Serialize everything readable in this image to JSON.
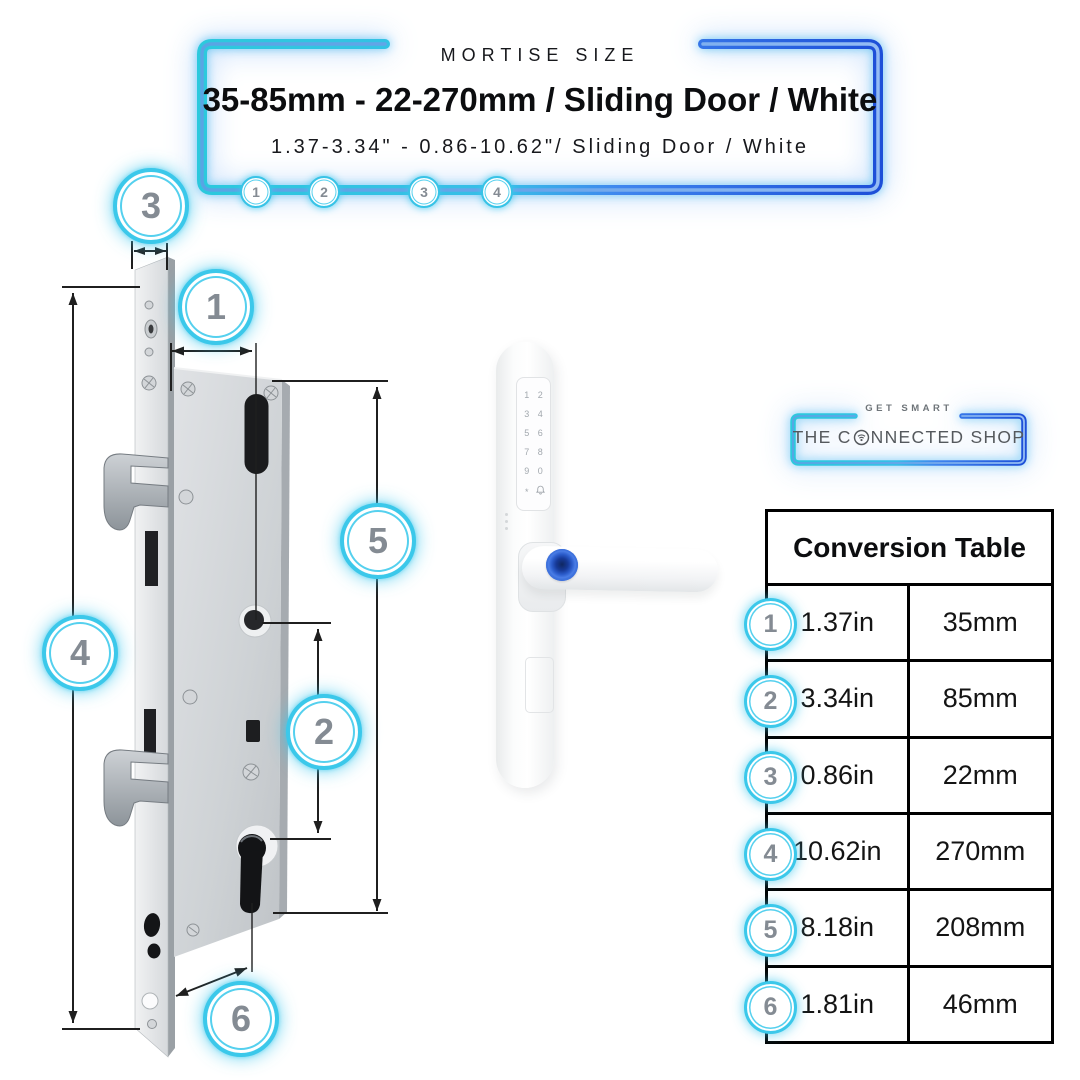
{
  "header": {
    "eyebrow": "MORTISE SIZE",
    "title": "35-85mm - 22-270mm / Sliding Door / White",
    "subtitle": "1.37-3.34\" - 0.86-10.62\"/ Sliding Door / White",
    "markers": [
      "1",
      "2",
      "3",
      "4"
    ]
  },
  "diagram": {
    "callouts": [
      "3",
      "1",
      "5",
      "4",
      "2",
      "6"
    ]
  },
  "handle": {
    "keys": [
      "1",
      "2",
      "3",
      "4",
      "5",
      "6",
      "7",
      "8",
      "9",
      "0",
      "*"
    ],
    "icons": [
      "doorbell-icon",
      "fingerprint-sensor"
    ]
  },
  "brand": {
    "tagline": "GET SMART",
    "name_prefix": "THE C",
    "name_suffix": "NNECTED SHOP",
    "o_icon": "wifi-icon"
  },
  "table": {
    "title": "Conversion Table",
    "rows": [
      {
        "num": "1",
        "inches": "1.37in",
        "mm": "35mm"
      },
      {
        "num": "2",
        "inches": "3.34in",
        "mm": "85mm"
      },
      {
        "num": "3",
        "inches": "0.86in",
        "mm": "22mm"
      },
      {
        "num": "4",
        "inches": "10.62in",
        "mm": "270mm"
      },
      {
        "num": "5",
        "inches": "8.18in",
        "mm": "208mm"
      },
      {
        "num": "6",
        "inches": "1.81in",
        "mm": "46mm"
      }
    ]
  },
  "colors": {
    "accent_cyan": "#35c8e8",
    "accent_blue": "#2257e0",
    "number_gray": "#848b93",
    "table_border": "#000000",
    "fingerprint_blue": "#2b5ccb"
  }
}
